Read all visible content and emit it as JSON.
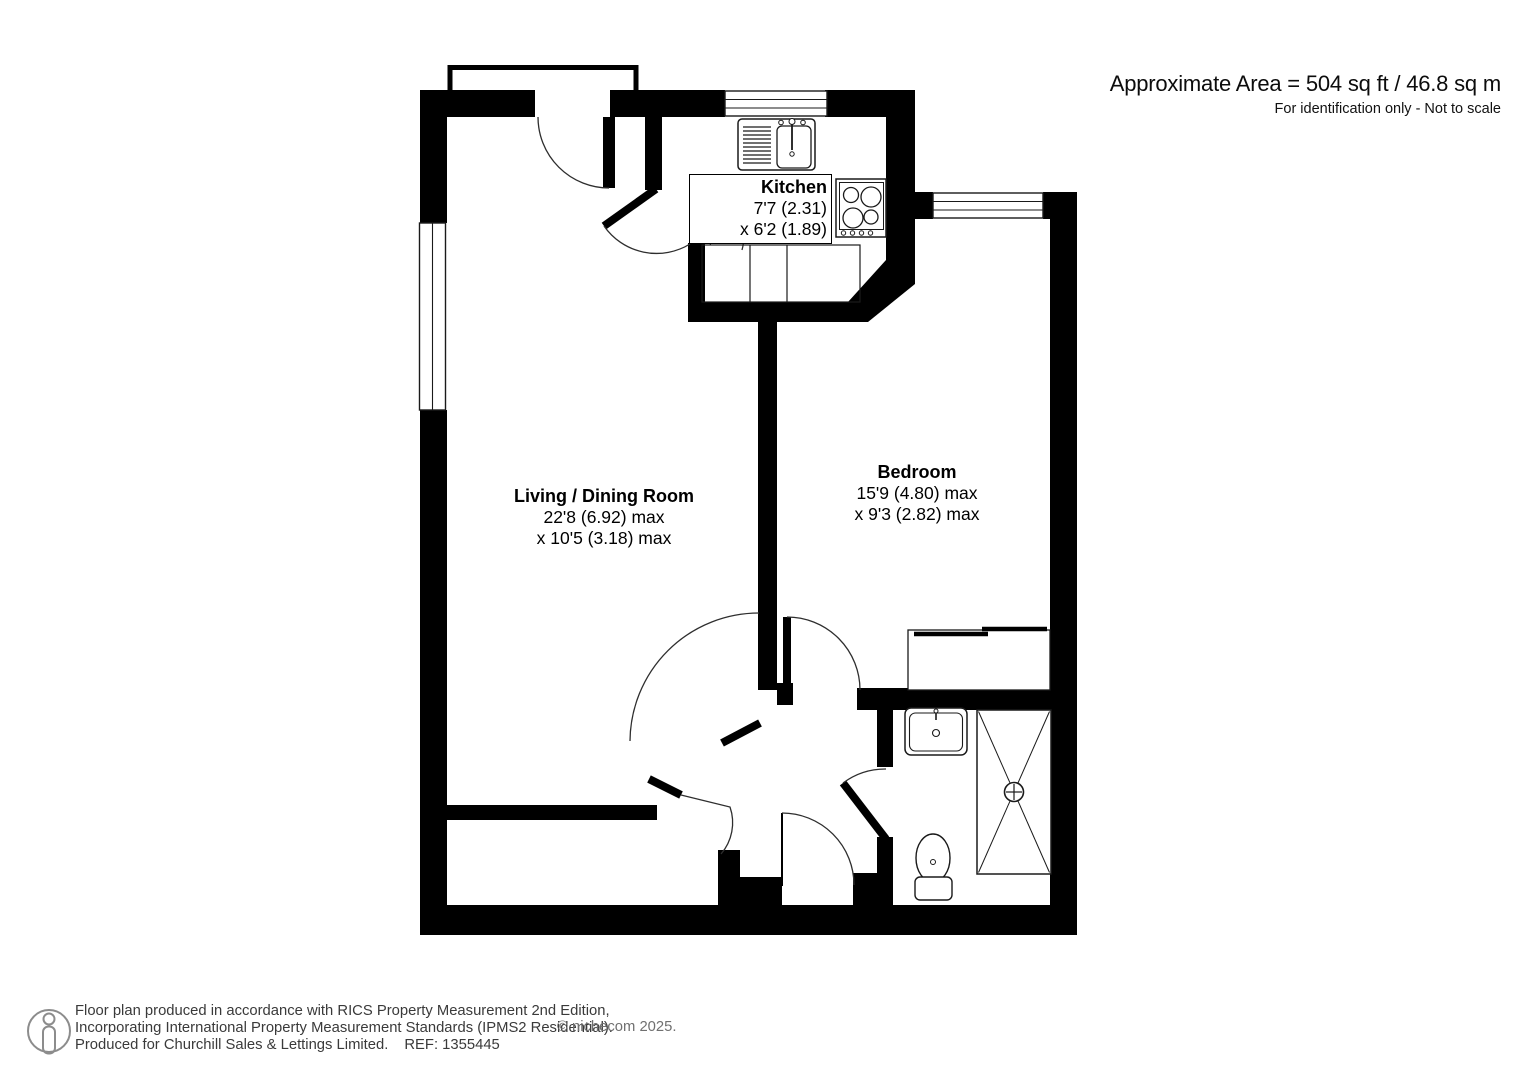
{
  "header": {
    "area_text": "Approximate Area = 504 sq ft / 46.8 sq m",
    "disclaimer": "For identification only - Not to scale"
  },
  "rooms": {
    "living": {
      "name": "Living / Dining Room",
      "dim1": "22'8 (6.92) max",
      "dim2": "x 10'5 (3.18) max"
    },
    "kitchen": {
      "name": "Kitchen",
      "dim1": "7'7 (2.31)",
      "dim2": "x 6'2 (1.89)"
    },
    "bedroom": {
      "name": "Bedroom",
      "dim1": "15'9 (4.80) max",
      "dim2": "x 9'3 (2.82) max"
    }
  },
  "fixtures": [
    "kitchen-sink-drainer",
    "hob",
    "kitchen-counter",
    "entrance-porch",
    "bathroom-basin",
    "toilet",
    "shower-tray",
    "wardrobe",
    "window"
  ],
  "footer": {
    "line1": "Floor plan produced in accordance with RICS Property Measurement 2nd Edition,",
    "line2": "Incorporating International Property Measurement Standards (IPMS2 Residential).",
    "line3": "Produced for Churchill Sales & Lettings Limited.",
    "ref": "REF: 1355445",
    "copyright": "© nichecom 2025."
  },
  "colors": {
    "wall": "#000000",
    "fixture_line": "#1a1a1a",
    "door_arc": "#2e2e2e",
    "footer_text": "#3a3a3a",
    "copyright_text": "#707070",
    "icon_gray": "#8c8c8c"
  }
}
